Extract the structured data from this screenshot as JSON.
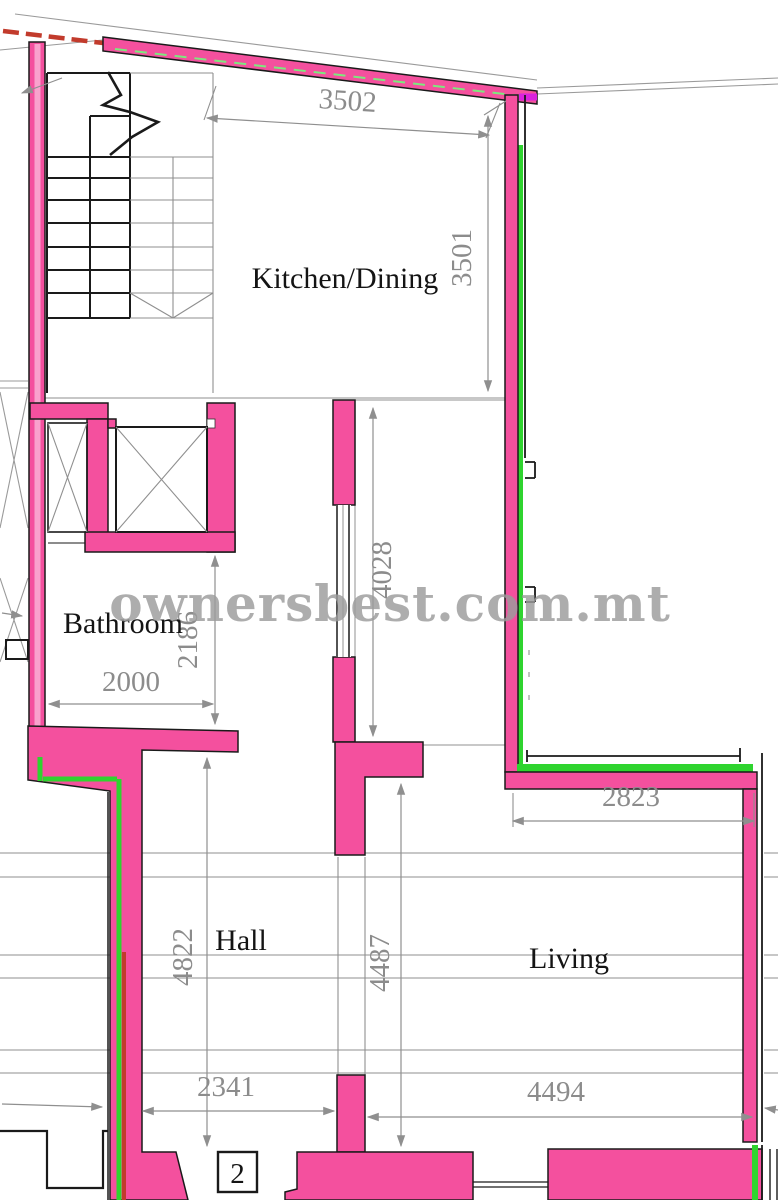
{
  "watermark": "ownersbest.com.mt",
  "rooms": {
    "kitchen": "Kitchen/Dining",
    "bathroom": "Bathroom",
    "hall": "Hall",
    "living": "Living"
  },
  "dimensions": {
    "top_width": "3502",
    "kitchen_height": "3501",
    "shaft_height": "4028",
    "bathroom_height": "2186",
    "bathroom_width": "2000",
    "living_top_width": "2823",
    "hall_height": "4822",
    "hall_mid_height": "4487",
    "hall_bottom_width": "2341",
    "living_bottom_width": "4494"
  },
  "door_tag": "2",
  "colors": {
    "wall_pink": "#f4509e",
    "wall_pink_light": "#f9a2cd",
    "line_green": "#2fd42f",
    "line_red": "#c23b2c",
    "line_magenta": "#da22dd",
    "dim_gray": "#8f8f8f",
    "watermark_gray": "#9c9c9c"
  }
}
